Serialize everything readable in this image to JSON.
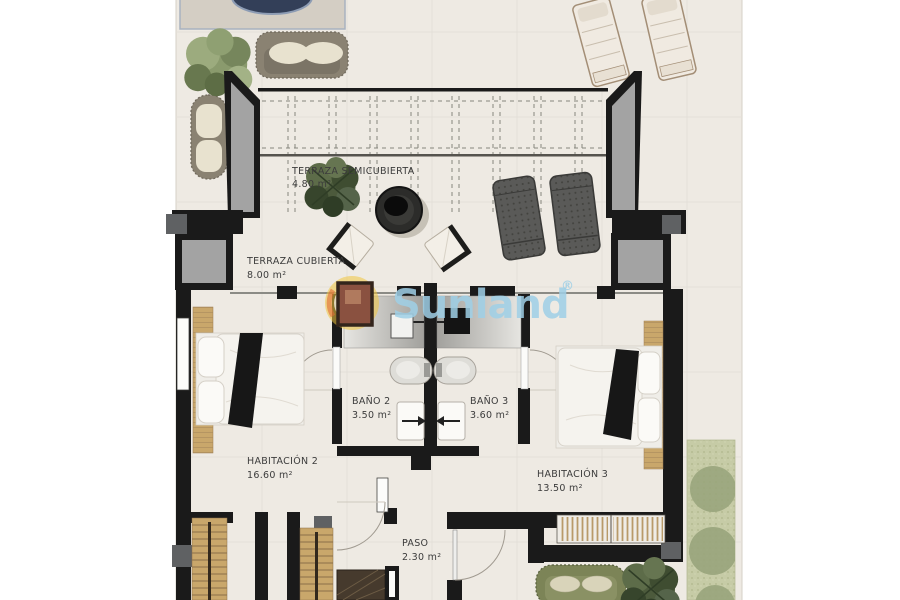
{
  "document": {
    "type": "floor-plan",
    "background": "#ffffff"
  },
  "watermark": {
    "brand": "Sunland",
    "registered": "®",
    "text_color": "#9fd0e7",
    "sun_color": "#f0c43e",
    "crescent_color": "#e06a35"
  },
  "rooms": {
    "terraza_semicubierta": {
      "name": "TERRAZA SEMICUBIERTA",
      "area": "4.80 m²"
    },
    "terraza_cubierta": {
      "name": "TERRAZA CUBIERTA",
      "area": "8.00 m²"
    },
    "bano2": {
      "name": "BAÑO 2",
      "area": "3.50 m²"
    },
    "bano3": {
      "name": "BAÑO 3",
      "area": "3.60 m²"
    },
    "habitacion2": {
      "name": "HABITACIÓN 2",
      "area": "16.60 m²"
    },
    "habitacion3": {
      "name": "HABITACIÓN 3",
      "area": "13.50 m²"
    },
    "paso": {
      "name": "PASO",
      "area": "2.30 m²"
    }
  },
  "colors": {
    "wall": "#1a1a1a",
    "wall_grey_fill": "#a3a3a3",
    "dark_grey_block": "#5f6163",
    "floor": "#eeeae3",
    "wood": "#c9a76b",
    "garden": "#c6cba6",
    "label_text": "#3c3c3c",
    "pool": "#333f58"
  }
}
